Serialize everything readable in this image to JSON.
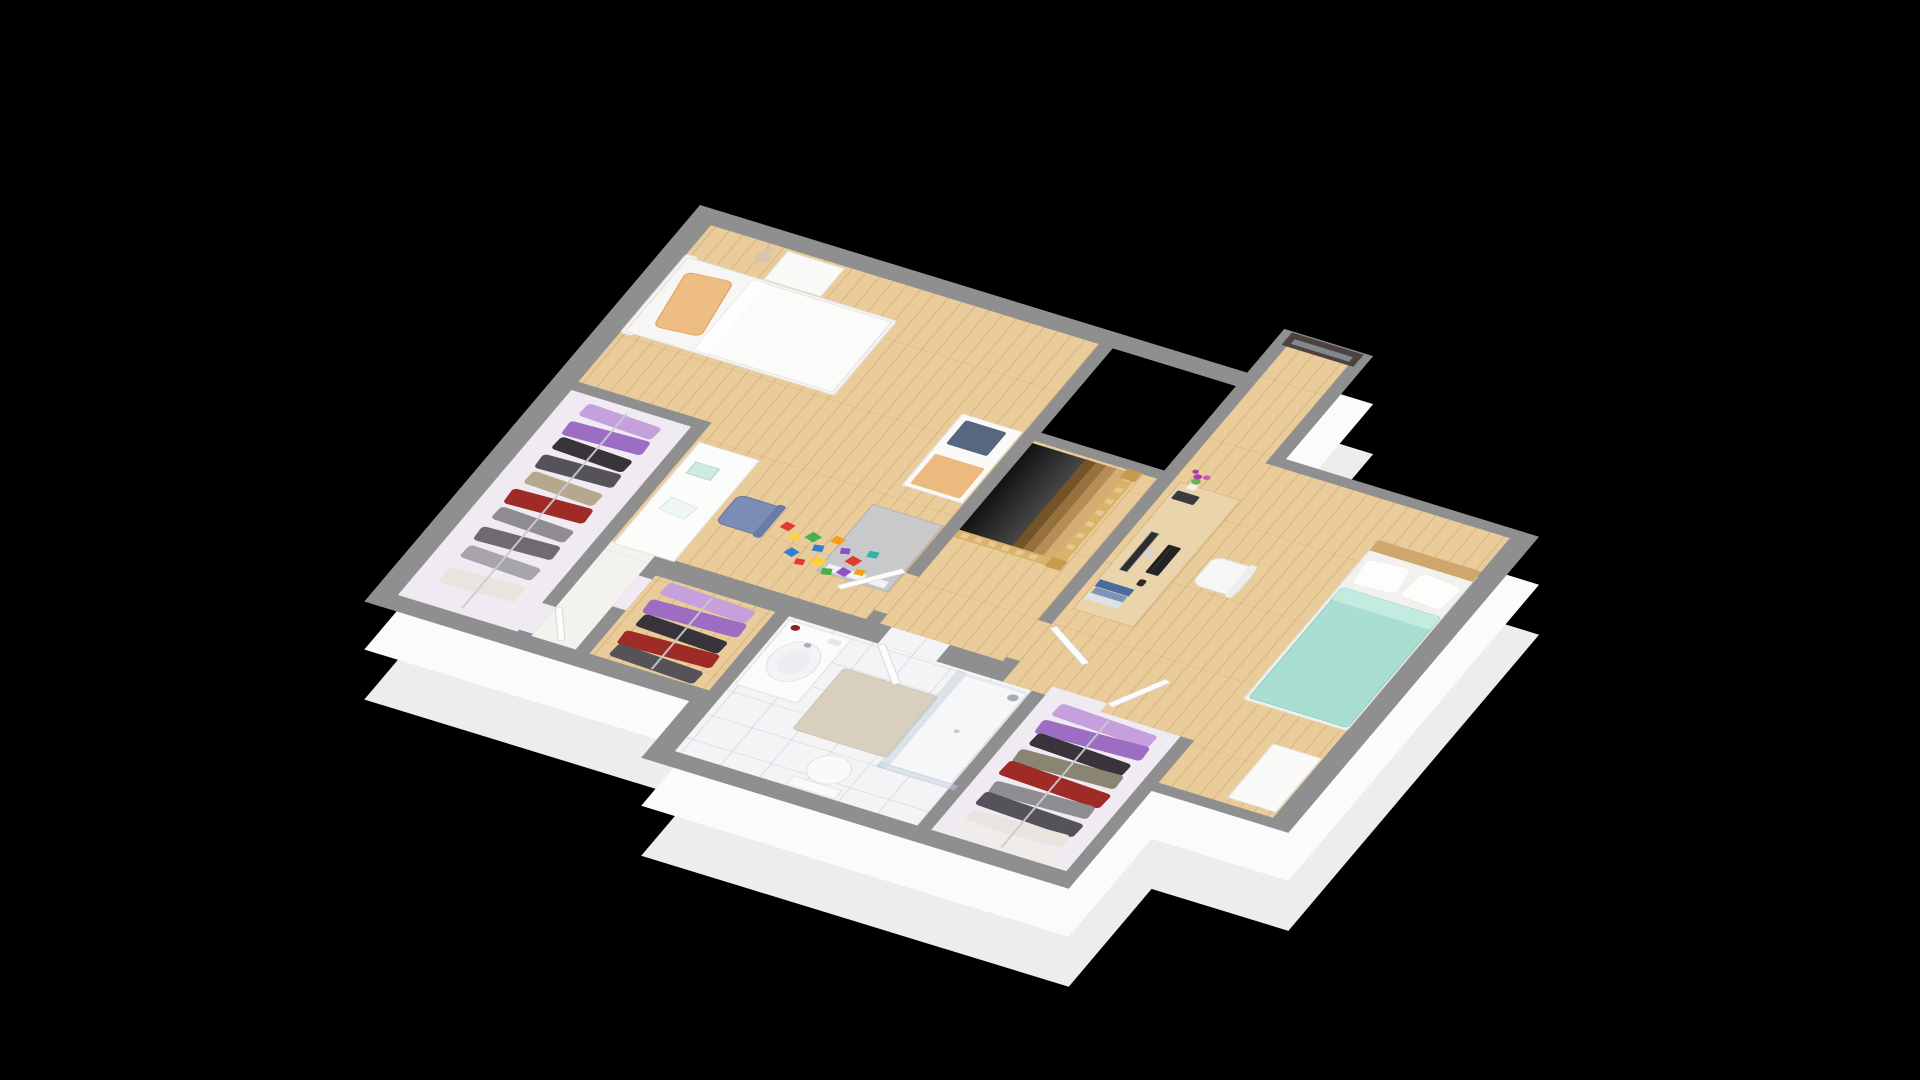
{
  "scene": {
    "description": "3D isometric floor plan of an upper storey with two bedrooms, bathroom, three walk-in closets, stairwell and window bay",
    "background": "#000000"
  },
  "palette": {
    "wall": "#8f8f8f",
    "skirt": "#fbfbfb",
    "skirt_shadow": "#ededed",
    "wood_base": "#e9cc9a",
    "closet_floor": "#f0ebf2",
    "corridor_floor": "#f4f2ef",
    "tile_base": "#f4f4f6",
    "void_black": "#000000",
    "rail_wood": "#d9b36c",
    "rail_spindle": "#e8c98f",
    "newel": "#c89a4e",
    "tread_1": "#d4ad74",
    "tread_2": "#b78d55",
    "tread_3": "#96703d",
    "tread_4": "#745426",
    "bed_white": "#f7f6f4",
    "duvet_white": "#fbfbf9",
    "pillow_orange": "#edbd83",
    "nightstand": "#fafaf8",
    "teddy": "#d9c5af",
    "shelf_white": "#fafaf8",
    "bin_blue": "#56677f",
    "pad_orange": "#ecb97e",
    "cabinet_gray": "#c9c9cb",
    "desk_white": "#fcfcfb",
    "paper_teal": "#cfe9e3",
    "paper_white": "#f0f8f6",
    "chair_blue": "#7b8db4",
    "chair_blue_dark": "#6a7ca6",
    "desk_wood": "#ead4ab",
    "monitor_dark": "#2d2d31",
    "monitor_stand": "#d3d4d6",
    "keyboard_black": "#232326",
    "mouse_black": "#2c2c2f",
    "device_dark": "#3b3b3f",
    "book_blue": "#4a6b9e",
    "book_blue_light": "#7b94bb",
    "book_pale": "#dce2e9",
    "flower_purple": "#a83fa8",
    "flower_purple_light": "#c45ec4",
    "plant_green": "#6fae5c",
    "vase_white": "#f0f0ee",
    "chair_white": "#f6f6f4",
    "chair_white_back": "#eeedeb",
    "bed2_frame": "#f3f1ee",
    "headboard_wood": "#cfa66b",
    "mint": "#a9dfd2",
    "mint_highlight": "#c3ebe0",
    "pillow_white": "#fdfdfc",
    "cabinet_white": "#fafaf9",
    "vanity_white": "#fbfbfb",
    "basin": "#f3f4f6",
    "candle_red": "#8c2024",
    "toilet_white": "#fafafa",
    "mat_beige": "#d8cfbe",
    "shower_tray": "#f6f7f9",
    "shower_glass": "#c7d6e2",
    "shower_metal": "#a9aeb5",
    "door_white": "#fdfdfd",
    "window_frame_dark": "#4c4340",
    "window_glass": "#aebfc9",
    "hanger_wood": "#d8b679",
    "rail_metal": "#c9ccd1"
  },
  "closets": {
    "c1": {
      "items": [
        "#c69fdd",
        "#9d6cc3",
        "#39343b",
        "#56525a",
        "#b5a88f",
        "#9e2b26",
        "#8f8c92",
        "#6e6a70",
        "#a7a4aa",
        "#e9e5de"
      ]
    },
    "c2": {
      "items": [
        "#c69fdd",
        "#9d6cc3",
        "#39343b",
        "#9e2b26",
        "#56525a"
      ]
    },
    "c3": {
      "items": [
        "#c69fdd",
        "#9d6cc3",
        "#39343b",
        "#8a8472",
        "#9e2b26",
        "#8f8c92",
        "#56525a",
        "#e9e5de",
        "#efecea"
      ]
    }
  },
  "toys": {
    "blocks": [
      "#e03a2c",
      "#ffd23b",
      "#49b04a",
      "#2f80d0",
      "#f59d1c",
      "#9050cc",
      "#e03a2c",
      "#29b6a8",
      "#2f80d0",
      "#e03a2c",
      "#ffd23b",
      "#49b04a",
      "#9050cc",
      "#f59d1c"
    ]
  }
}
